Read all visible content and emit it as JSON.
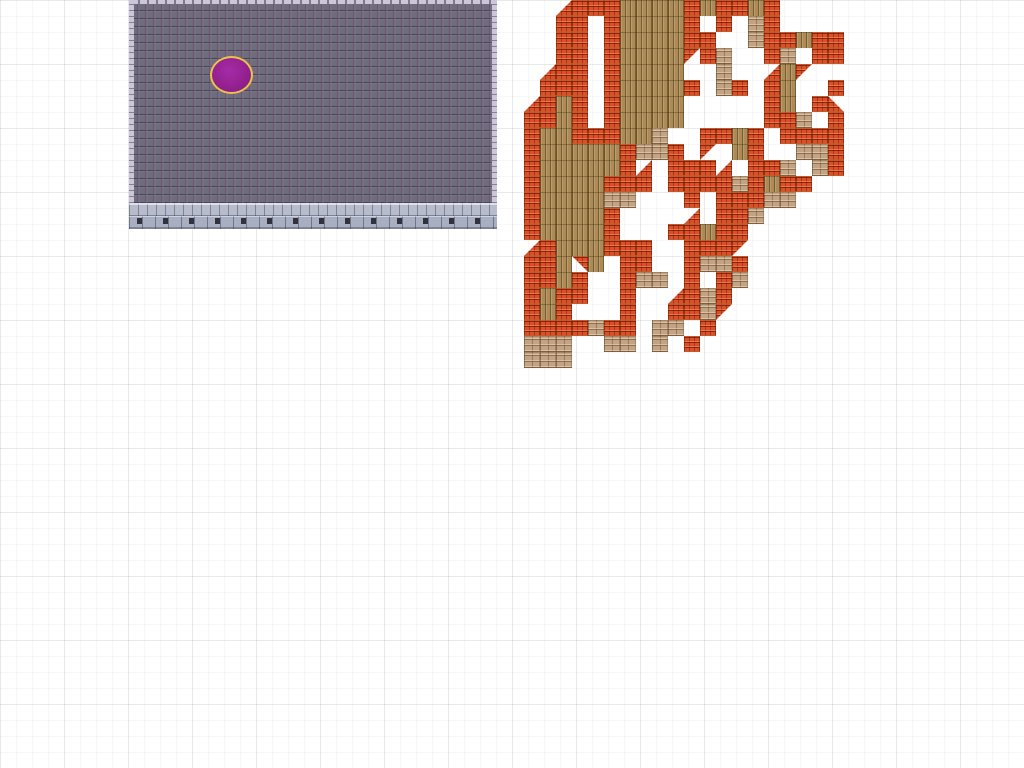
{
  "canvas": {
    "width": 1024,
    "height": 768,
    "background": "#ffffff",
    "grid": {
      "minor_size": 16,
      "major_size": 64,
      "minor_color": "rgba(0,0,0,0.032)",
      "major_color": "rgba(0,0,0,0.055)"
    }
  },
  "wall_chunk": {
    "x": 129,
    "y": 0,
    "width": 368,
    "height": 229,
    "cap_height": 4,
    "edge_width": 5,
    "base_top_y": 203,
    "base_split_y": 216
  },
  "ellipse_object": {
    "x": 210,
    "y": 56,
    "width": 43,
    "height": 38,
    "fill": "#94218f",
    "stroke": "#eec04c",
    "stroke_width": 2
  },
  "roof_chunk": {
    "x": 524,
    "y": 0,
    "tile_size": 16,
    "columns": 20,
    "legend": {
      ".": "empty",
      "b": "orange-brick-roof",
      "w": "wood-planks",
      "s": "tan-stone-bricks",
      "1": "brick-diagonal-cut-top-left",
      "2": "brick-diagonal-cut-top-right",
      "3": "brick-diagonal-cut-bottom-left",
      "4": "brick-diagonal-cut-bottom-right"
    },
    "rows": [
      "..1bbbwwwwbwbbwb....",
      "..bb.bwwwwb.b.sb....",
      "..bb.bwwwwbb..sbbwbb",
      "..bb.bwwww4bs..bs.bb",
      ".1bb.bwwww..s..1w4..",
      ".bbb.bwwwwb.sb.bw..b",
      "1bwb.bwwww.....bw.b2",
      "bbwb.bwwww.....bbs.b",
      "bwwbbbwws..bbwb.bbbb",
      "bwwwwwbssb.4.wb..ssb",
      "bwwwwwb1.bbb1.bbs.sb",
      "bwwwwbbb.bbbbsbwbb..",
      "bwwwwss...b.bbbss...",
      "bwwwwb....1.bbs.....",
      "bwwwwb...bbwbb......",
      "1bwwwbbb..bbb4......",
      "bbw3w.bb..bssb......",
      "bbwb..bss.b.bs......",
      "bwbb..b..1bsb.......",
      "bwb...b..bbs4.......",
      "bbbbsbb.ss.b........",
      "sss..ss.s.b.........",
      "sss................."
    ]
  },
  "palette": {
    "brick_base": "#dd4f26",
    "brick_dark": "#8e2608",
    "brick_light": "#f59a66",
    "wood_base": "#ad8b57",
    "wood_dark": "#6e532f",
    "stone_base": "#c4a383",
    "stone_dark": "#8a6c50",
    "wall_base": "#6f6c7d",
    "wall_dark": "#3f3b4c",
    "wall_edge": "#cdc6da",
    "wall_stone_light": "#b6bccc",
    "wall_stone_mid": "#a9afc2",
    "wall_hole": "#32323e"
  }
}
